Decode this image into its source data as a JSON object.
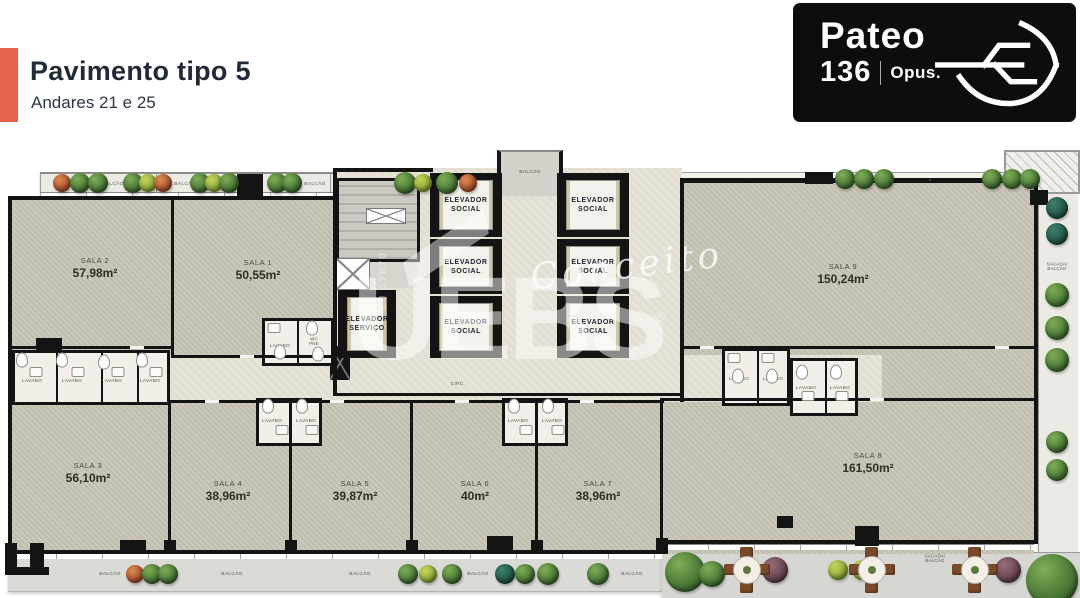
{
  "header": {
    "title": "Pavimento tipo 5",
    "subtitle": "Andares 21 e 25"
  },
  "logo": {
    "name": "Pateo",
    "number": "136",
    "brand": "Opus.",
    "icon": "boat-leaf-icon"
  },
  "watermark": {
    "script": "Conceito",
    "big": "UEBS",
    "registered": "®",
    "vertical": "CJ 17870"
  },
  "colors": {
    "accent": "#E4614D",
    "floor": "#C9C5B7",
    "corridor": "#E7E1D6",
    "wall": "#141414",
    "logo_bg": "#0D0D0D",
    "title_text": "#212B38"
  },
  "rooms": {
    "sala1": {
      "name": "SALA 1",
      "area": "50,55m²"
    },
    "sala2": {
      "name": "SALA 2",
      "area": "57,98m²"
    },
    "sala3": {
      "name": "SALA 3",
      "area": "56,10m²"
    },
    "sala4": {
      "name": "SALA 4",
      "area": "38,96m²"
    },
    "sala5": {
      "name": "SALA 5",
      "area": "39,87m²"
    },
    "sala6": {
      "name": "SALA 6",
      "area": "40m²"
    },
    "sala7": {
      "name": "SALA 7",
      "area": "38,96m²"
    },
    "sala8": {
      "name": "SALA 8",
      "area": "161,50m²"
    },
    "sala9": {
      "name": "SALA 9",
      "area": "150,24m²"
    }
  },
  "core": {
    "elevator_social_line1": "ELEVADOR",
    "elevator_social_line2": "SOCIAL",
    "elevator_service_line1": "ELEVADOR",
    "elevator_service_line2": "SERVIÇO"
  },
  "labels": {
    "balcao": "BALCÃO",
    "lavabo": "LAVABO",
    "wc_line1": "WC",
    "wc_line2": "PNE",
    "circ": "CIRC.",
    "sacada_line1": "SACADA/",
    "sacada_line2": "BALCÃO"
  }
}
